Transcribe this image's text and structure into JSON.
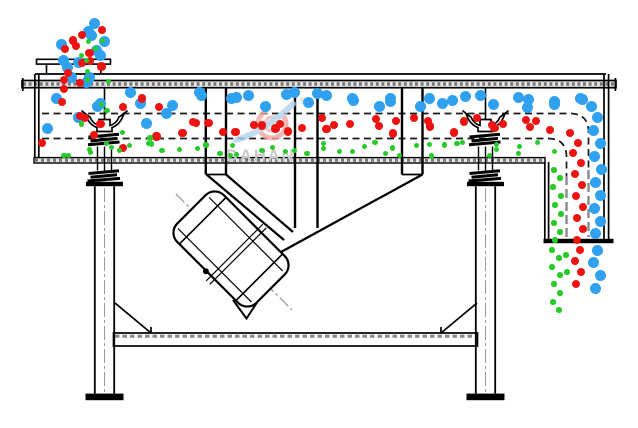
{
  "watermark": {
    "text": "DAHAN",
    "registered": "®"
  },
  "colors": {
    "background": "#ffffff",
    "line": "#000000",
    "hatch_fill": "#e9e9e9",
    "hatch_dash": "#777777",
    "centerline_gray": "#999999",
    "watermark_text": "#c9c9c9",
    "logo_red": "#f0a8a3",
    "logo_blue": "#b5d3ec",
    "dots": {
      "blue": "#2fa1f0",
      "red": "#ee1310",
      "green": "#27cb27"
    }
  },
  "particles": {
    "dot_radius": {
      "blue": 5.5,
      "red": 4.1,
      "green": 2.6
    },
    "layers": [
      {
        "name": "feed-stream-blue",
        "color": "blue",
        "axis": "v",
        "x0": 58,
        "x1": 106,
        "y0": 24,
        "y1": 88,
        "count": 13,
        "seed": 101
      },
      {
        "name": "feed-stream-red",
        "color": "red",
        "axis": "v",
        "x0": 60,
        "x1": 104,
        "y0": 30,
        "y1": 90,
        "count": 13,
        "seed": 202
      },
      {
        "name": "feed-stream-green",
        "color": "green",
        "axis": "v",
        "x0": 64,
        "x1": 112,
        "y0": 33,
        "y1": 88,
        "count": 8,
        "seed": 303
      },
      {
        "name": "inlet-mix-blue",
        "color": "blue",
        "axis": "h",
        "x0": 44,
        "x1": 168,
        "y0": 92,
        "y1": 133,
        "count": 9,
        "seed": 404
      },
      {
        "name": "inlet-mix-red",
        "color": "red",
        "axis": "h",
        "x0": 45,
        "x1": 168,
        "y0": 97,
        "y1": 150,
        "count": 11,
        "seed": 505
      },
      {
        "name": "inlet-mix-green",
        "color": "green",
        "axis": "h",
        "x0": 50,
        "x1": 168,
        "y0": 102,
        "y1": 140,
        "count": 5,
        "seed": 606
      },
      {
        "name": "top-deck-blue-layer",
        "color": "blue",
        "axis": "h",
        "x0": 172,
        "x1": 584,
        "y0": 92,
        "y1": 108,
        "count": 30,
        "seed": 707
      },
      {
        "name": "middle-deck-red-layer",
        "color": "red",
        "axis": "h",
        "x0": 172,
        "x1": 562,
        "y0": 117,
        "y1": 135,
        "count": 33,
        "seed": 808
      },
      {
        "name": "bottom-deck-green-layer",
        "color": "green",
        "axis": "h",
        "x0": 56,
        "x1": 552,
        "y0": 142,
        "y1": 156,
        "count": 46,
        "seed": 909
      }
    ],
    "streams": [
      {
        "name": "coarse-overflow-bend",
        "color": "blue",
        "points": [
          [
            580,
            98
          ],
          [
            591,
            106
          ],
          [
            597,
            117
          ],
          [
            593,
            130
          ],
          [
            600,
            143
          ],
          [
            594,
            156
          ],
          [
            601,
            169
          ],
          [
            595,
            182
          ],
          [
            600,
            195
          ],
          [
            594,
            208
          ],
          [
            600,
            221
          ],
          [
            595,
            233
          ]
        ]
      },
      {
        "name": "coarse-outlet-flow",
        "color": "blue",
        "points": [
          [
            597,
            250
          ],
          [
            593,
            262
          ],
          [
            600,
            275
          ],
          [
            595,
            288
          ]
        ]
      },
      {
        "name": "medium-overflow-bend",
        "color": "red",
        "points": [
          [
            570,
            133
          ],
          [
            578,
            143
          ],
          [
            573,
            153
          ],
          [
            581,
            163
          ],
          [
            575,
            174
          ],
          [
            582,
            185
          ],
          [
            576,
            196
          ],
          [
            583,
            207
          ],
          [
            577,
            218
          ],
          [
            583,
            229
          ],
          [
            577,
            240
          ]
        ]
      },
      {
        "name": "medium-outlet-flow",
        "color": "red",
        "points": [
          [
            580,
            250
          ],
          [
            575,
            261
          ],
          [
            581,
            272
          ],
          [
            576,
            284
          ]
        ]
      },
      {
        "name": "fine-underflow-bend",
        "color": "green",
        "points": [
          [
            554,
            170
          ],
          [
            560,
            178
          ],
          [
            553,
            187
          ],
          [
            561,
            196
          ],
          [
            555,
            205
          ],
          [
            561,
            214
          ],
          [
            554,
            223
          ],
          [
            560,
            232
          ],
          [
            555,
            240
          ]
        ]
      },
      {
        "name": "fine-outlet-flow",
        "color": "green",
        "points": [
          [
            552,
            250
          ],
          [
            559,
            258
          ],
          [
            552,
            267
          ],
          [
            560,
            275
          ],
          [
            554,
            284
          ],
          [
            560,
            293
          ],
          [
            553,
            302
          ],
          [
            559,
            310
          ],
          [
            566,
            255
          ],
          [
            567,
            272
          ]
        ]
      }
    ]
  }
}
